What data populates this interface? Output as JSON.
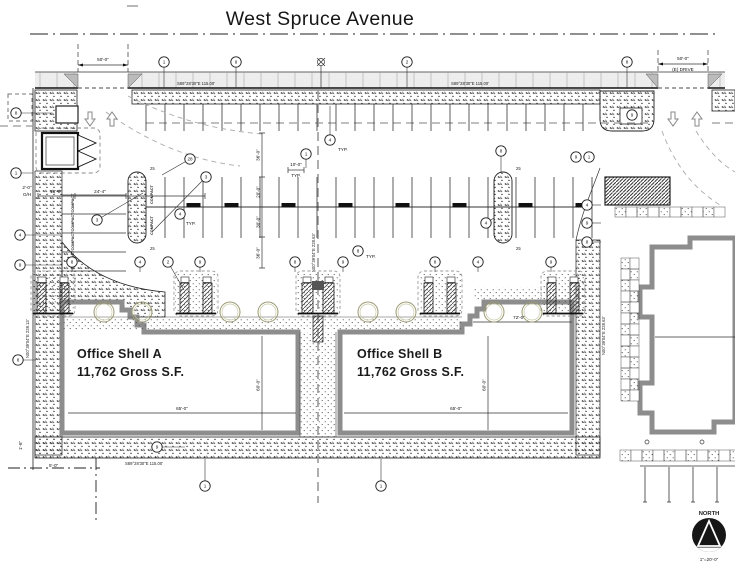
{
  "title": "West Spruce Avenue",
  "buildings": {
    "a": {
      "name": "Office Shell A",
      "area": "11,762 Gross S.F."
    },
    "b": {
      "name": "Office Shell B",
      "area": "11,762 Gross S.F."
    }
  },
  "bearings": {
    "top_left": "S89°28'30\"E  115.00'",
    "top_right": "S89°28'30\"E  115.00'",
    "left": "N00°39'04\"E  228.13'",
    "center": "N00°39'04\"E  228.63'",
    "right": "N00°39'04\"E  228.63'",
    "bottom": "S89°28'30\"E  115.00'"
  },
  "dimensions": {
    "drive_left": "50'-0\"",
    "drive_right": "50'-0\"",
    "drive_right_note": "(E) DRIVE",
    "stall_typ": "10'-0\"",
    "typ": "TYP.",
    "overhang_a": "2'-0\"",
    "overhang_b": "O/H",
    "compact_depth": "18'-0\"",
    "aisle_left": "24'-4\"",
    "chain": [
      "36'-0\"",
      "20'-0\"",
      "30'-0\"",
      "36'-0\""
    ],
    "bldg_width": "65'-0\"",
    "bldg_depth": "60'-0\"",
    "wing_width": "72'-0\"",
    "corner_a": "1'-6\"",
    "corner_b": "5'-0\"",
    "island_note": "25"
  },
  "labels": {
    "compact": "COMPACT"
  },
  "north": {
    "label": "NORTH",
    "scale": "1\"=20'-0\""
  },
  "keynotes": [
    {
      "n": "1",
      "x": 164,
      "y": 62,
      "lx": 164,
      "ly": 88
    },
    {
      "n": "9",
      "x": 236,
      "y": 62,
      "lx": 236,
      "ly": 88
    },
    {
      "n": "2",
      "x": 407,
      "y": 62,
      "lx": 407,
      "ly": 88
    },
    {
      "n": "8",
      "x": 627,
      "y": 62,
      "lx": 627,
      "ly": 88
    },
    {
      "n": "8",
      "x": 16,
      "y": 113,
      "lx": 52,
      "ly": 113
    },
    {
      "n": "1",
      "x": 16,
      "y": 173,
      "lx": 33,
      "ly": 173
    },
    {
      "n": "4",
      "x": 20,
      "y": 235,
      "lx": 62,
      "ly": 235
    },
    {
      "n": "9",
      "x": 20,
      "y": 265,
      "lx": 62,
      "ly": 265
    },
    {
      "n": "8",
      "x": 18,
      "y": 360,
      "lx": 36,
      "ly": 360
    },
    {
      "n": "4",
      "x": 330,
      "y": 140,
      "lx": 330,
      "ly": 106
    },
    {
      "n": "28",
      "x": 190,
      "y": 159,
      "lx": 162,
      "ly": 175
    },
    {
      "n": "1",
      "x": 306,
      "y": 154,
      "lx": 306,
      "ly": 168
    },
    {
      "n": "3",
      "x": 206,
      "y": 177,
      "lx": 152,
      "ly": 232
    },
    {
      "n": "3",
      "x": 97,
      "y": 220,
      "lx": 143,
      "ly": 193
    },
    {
      "n": "4",
      "x": 180,
      "y": 214
    },
    {
      "n": "8",
      "x": 358,
      "y": 251
    },
    {
      "n": "8",
      "x": 501,
      "y": 151,
      "lx": 501,
      "ly": 172
    },
    {
      "n": "4",
      "x": 486,
      "y": 223,
      "lx": 494,
      "ly": 218
    },
    {
      "n": "9",
      "x": 576,
      "y": 157
    },
    {
      "n": "1",
      "x": 589,
      "y": 157
    },
    {
      "n": "9",
      "x": 632,
      "y": 115
    },
    {
      "n": "8",
      "x": 72,
      "y": 262,
      "lx": 72,
      "ly": 272
    },
    {
      "n": "4",
      "x": 140,
      "y": 262,
      "lx": 140,
      "ly": 272
    },
    {
      "n": "2",
      "x": 168,
      "y": 262,
      "lx": 184,
      "ly": 290
    },
    {
      "n": "9",
      "x": 200,
      "y": 262,
      "lx": 200,
      "ly": 272
    },
    {
      "n": "8",
      "x": 295,
      "y": 262,
      "lx": 295,
      "ly": 272
    },
    {
      "n": "9",
      "x": 343,
      "y": 262,
      "lx": 343,
      "ly": 272
    },
    {
      "n": "8",
      "x": 435,
      "y": 262,
      "lx": 435,
      "ly": 272
    },
    {
      "n": "4",
      "x": 478,
      "y": 262,
      "lx": 478,
      "ly": 272
    },
    {
      "n": "9",
      "x": 551,
      "y": 262,
      "lx": 551,
      "ly": 272
    },
    {
      "n": "4",
      "x": 587,
      "y": 205,
      "lx": 601,
      "ly": 205
    },
    {
      "n": "9",
      "x": 587,
      "y": 223,
      "lx": 601,
      "ly": 223
    },
    {
      "n": "8",
      "x": 587,
      "y": 242,
      "lx": 601,
      "ly": 242
    },
    {
      "n": "9",
      "x": 157,
      "y": 447,
      "lx": 185,
      "ly": 447
    },
    {
      "n": "1",
      "x": 205,
      "y": 486,
      "lx": 205,
      "ly": 459
    },
    {
      "n": "1",
      "x": 381,
      "y": 486,
      "lx": 381,
      "ly": 459
    }
  ],
  "trees": [
    104,
    142,
    230,
    268,
    368,
    406,
    494,
    532
  ]
}
